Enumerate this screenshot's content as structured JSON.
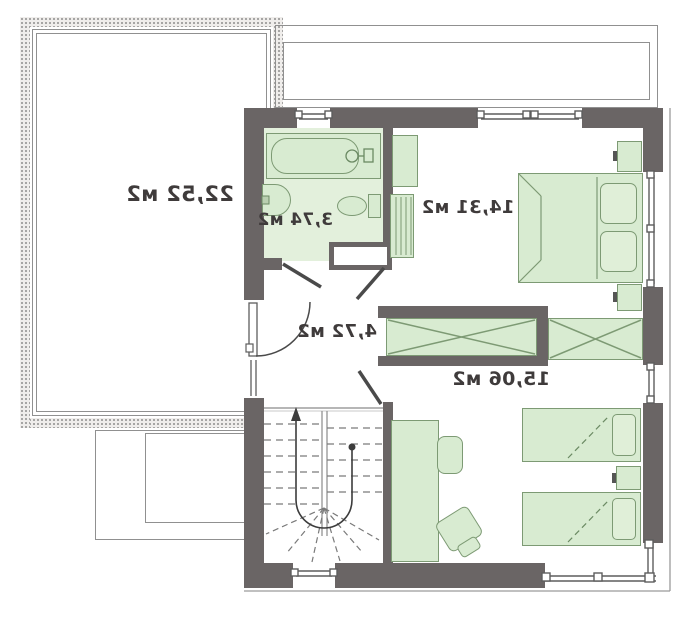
{
  "plan": {
    "type": "floor-plan",
    "floor": "upper floor with stair, mirrored drawing",
    "labels": {
      "terrace": "22,52 м2",
      "bathroom": "3,74 м2",
      "master_bedroom": "14,31 м2",
      "hallway": "4,72 м2",
      "second_bedroom": "15,06 м2"
    },
    "colors": {
      "wall": "#6a6565",
      "furniture_fill": "#d8ebd1",
      "furniture_stroke": "#7d9a74",
      "bathroom_floor": "#e3f0dc",
      "thin_line": "#909090",
      "text": "#3f3b3b"
    },
    "fixtures": [
      "terrace",
      "balcony-strip",
      "bathtub",
      "sink",
      "toilet",
      "duct-shaft",
      "double-bed",
      "nightstand",
      "nightstand",
      "wardrobe",
      "wardrobe",
      "single-bed",
      "single-bed",
      "nightstand",
      "desk",
      "chair",
      "chair",
      "winder-stairs",
      "balcony-door",
      "doors",
      "windows"
    ]
  }
}
